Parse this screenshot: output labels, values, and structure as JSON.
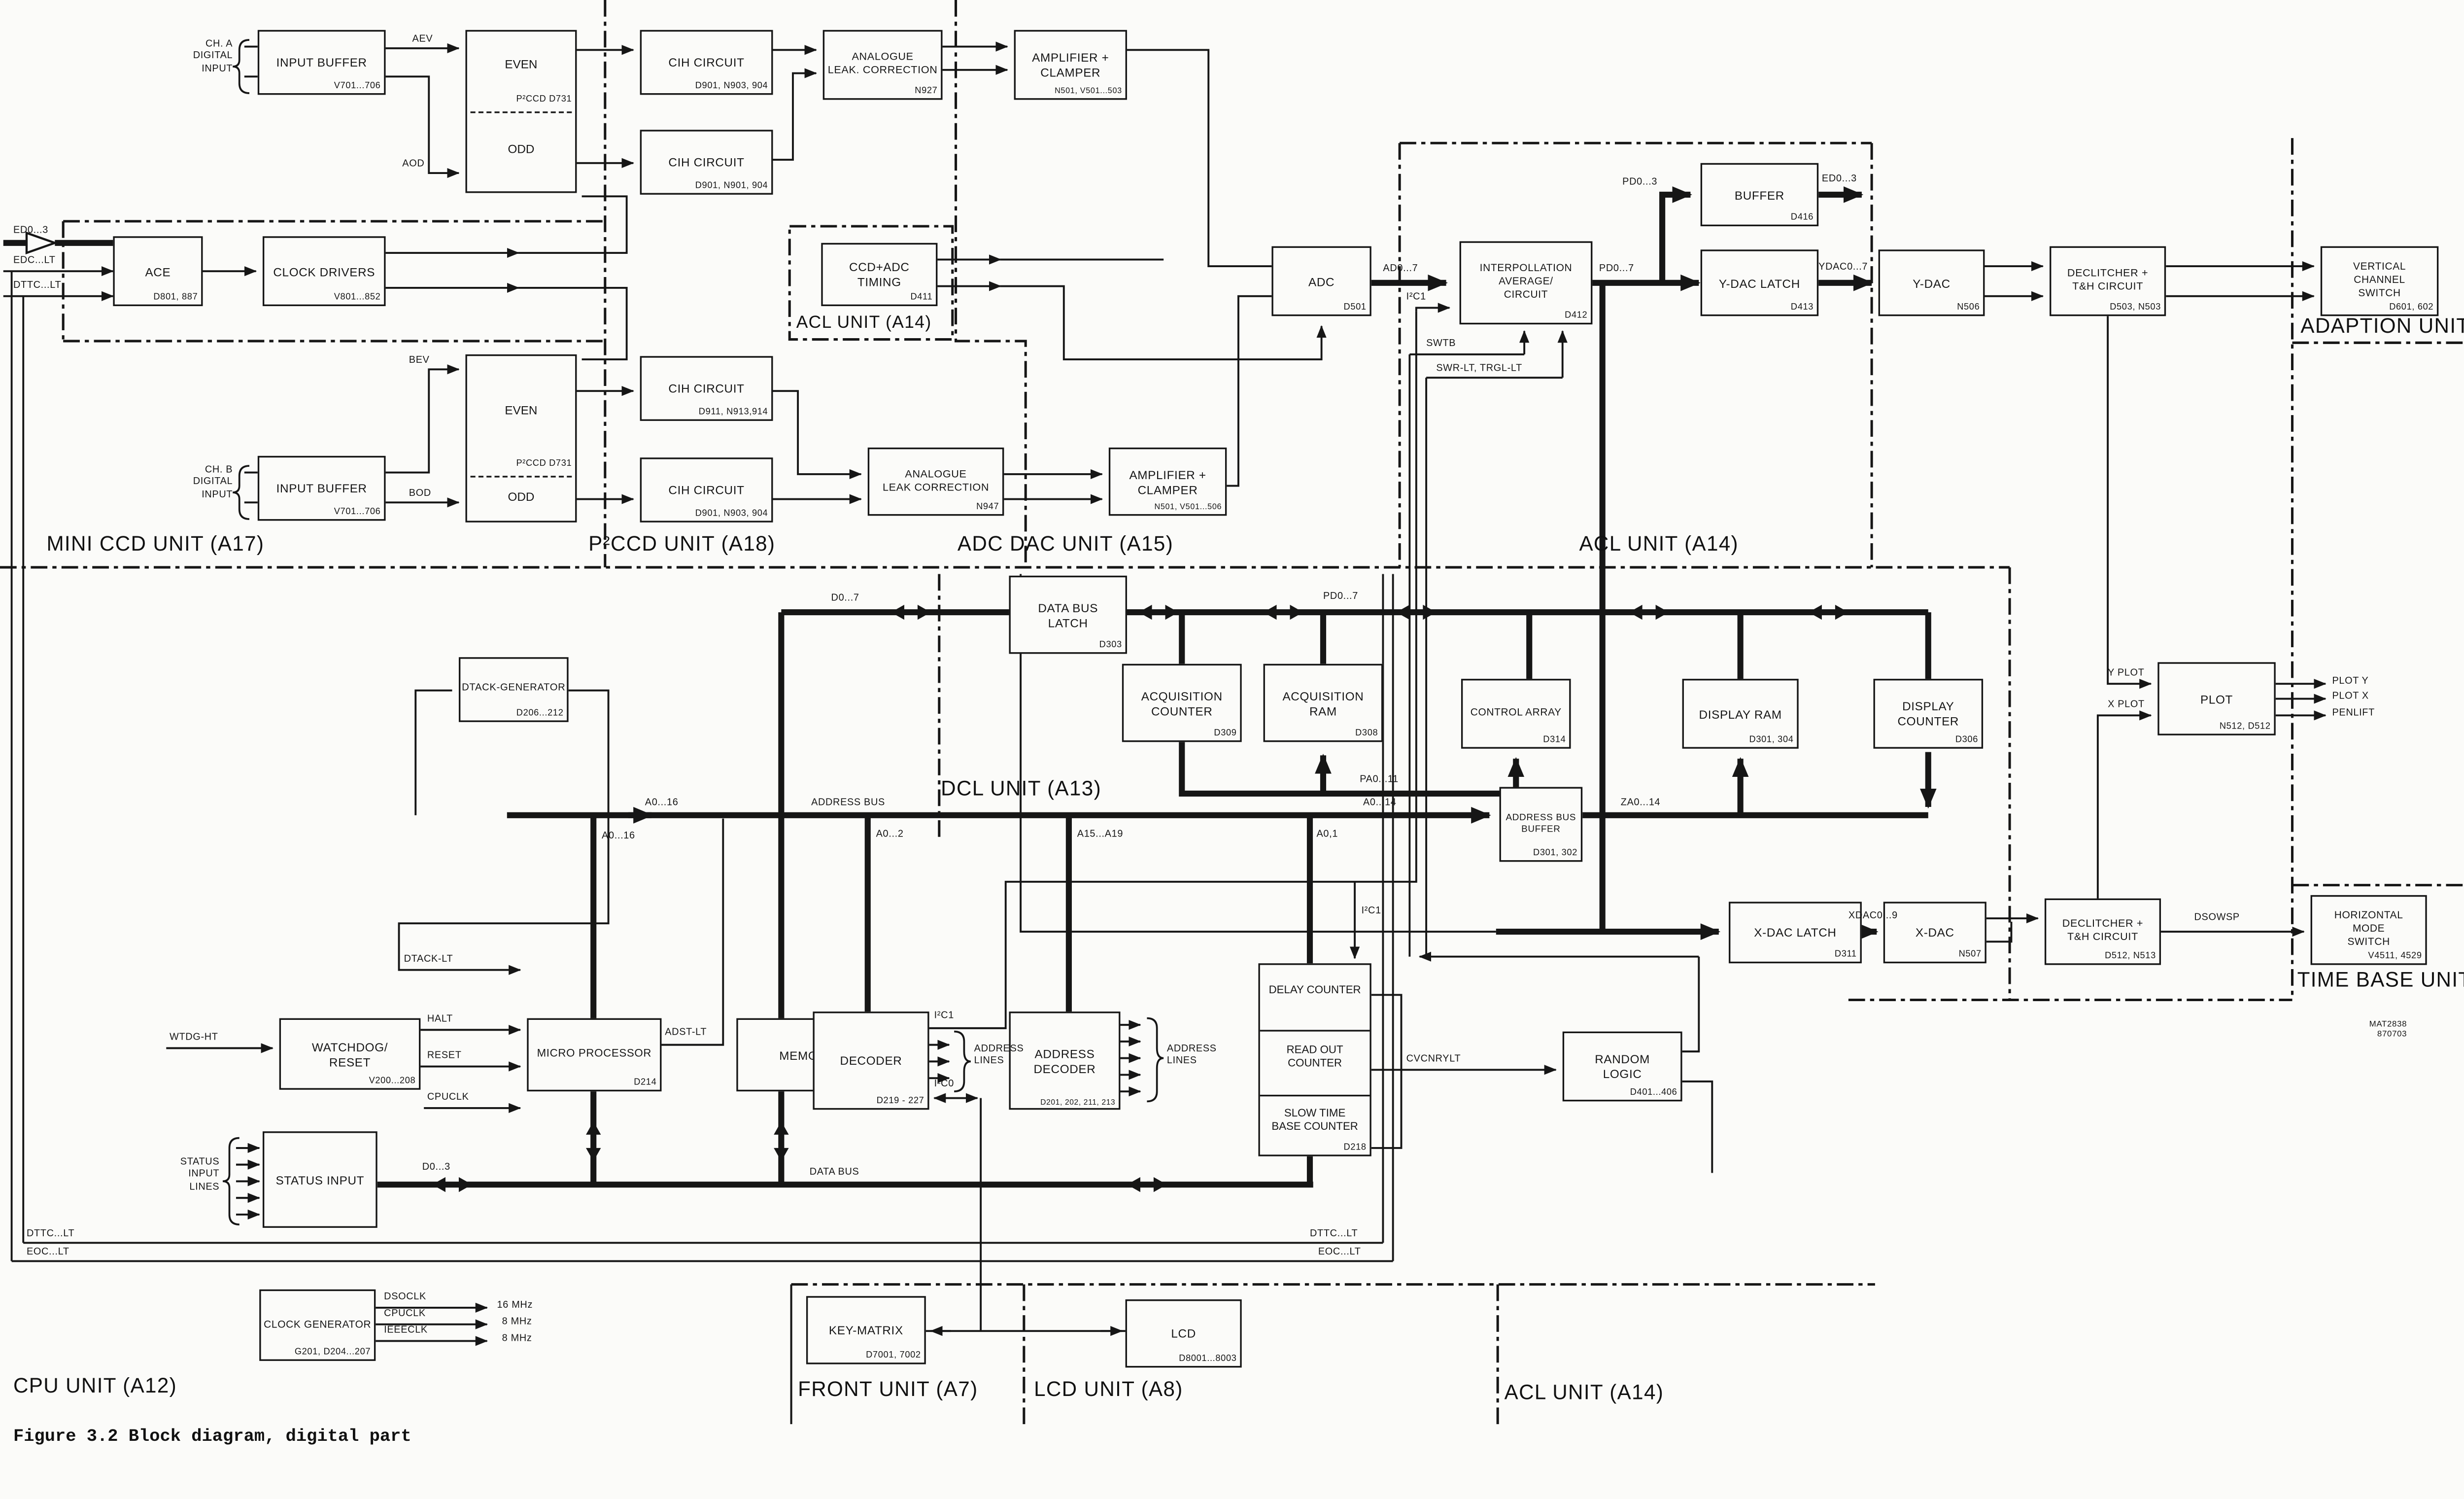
{
  "caption": "Figure 3.2 Block diagram, digital part",
  "blocks": {
    "input_buffer_a": {
      "label": "INPUT BUFFER",
      "part": "V701...706"
    },
    "even_odd_a": {
      "even": "EVEN",
      "odd": "ODD",
      "part": "P²CCD  D731"
    },
    "cih_a1": {
      "label": "CIH CIRCUIT",
      "part": "D901, N903, 904"
    },
    "cih_a2": {
      "label": "CIH CIRCUIT",
      "part": "D901, N901, 904"
    },
    "alc_a": {
      "label": "ANALOGUE\nLEAK. CORRECTION",
      "part": "N927"
    },
    "amp_a": {
      "label": "AMPLIFIER +\nCLAMPER",
      "part": "N501, V501...503"
    },
    "ace": {
      "label": "ACE",
      "part": "D801, 887"
    },
    "clock_drivers": {
      "label": "CLOCK DRIVERS",
      "part": "V801...852"
    },
    "ccd_adc_timing": {
      "label": "CCD+ADC\nTIMING",
      "part": "D411"
    },
    "input_buffer_b": {
      "label": "INPUT BUFFER",
      "part": "V701...706"
    },
    "even_odd_b": {
      "even": "EVEN",
      "odd": "ODD",
      "part": "P²CCD  D731"
    },
    "cih_b1": {
      "label": "CIH CIRCUIT",
      "part": "D911, N913,914"
    },
    "cih_b2": {
      "label": "CIH CIRCUIT",
      "part": "D901, N903, 904"
    },
    "alc_b": {
      "label": "ANALOGUE\nLEAK CORRECTION",
      "part": "N947"
    },
    "amp_b": {
      "label": "AMPLIFIER +\nCLAMPER",
      "part": "N501, V501...506"
    },
    "adc": {
      "label": "ADC",
      "part": "D501"
    },
    "interp": {
      "label": "INTERPOLLATION\nAVERAGE/\nCIRCUIT",
      "part": "D412"
    },
    "buffer": {
      "label": "BUFFER",
      "part": "D416"
    },
    "ydac_latch": {
      "label": "Y-DAC LATCH",
      "part": "D413"
    },
    "ydac": {
      "label": "Y-DAC",
      "part": "N506"
    },
    "declitcher_y": {
      "label": "DECLITCHER +\nT&H CIRCUIT",
      "part": "D503, N503"
    },
    "vcs": {
      "label": "VERTICAL\nCHANNEL\nSWITCH",
      "part": "D601, 602"
    },
    "data_bus_latch": {
      "label": "DATA BUS\nLATCH",
      "part": "D303"
    },
    "acq_counter": {
      "label": "ACQUISITION\nCOUNTER",
      "part": "D309"
    },
    "acq_ram": {
      "label": "ACQUISITION\nRAM",
      "part": "D308"
    },
    "control_array": {
      "label": "CONTROL ARRAY",
      "part": "D314"
    },
    "display_ram": {
      "label": "DISPLAY RAM",
      "part": "D301, 304"
    },
    "display_counter": {
      "label": "DISPLAY\nCOUNTER",
      "part": "D306"
    },
    "address_bus_buffer": {
      "label": "ADDRESS BUS\nBUFFER",
      "part": "D301, 302"
    },
    "plot": {
      "label": "PLOT",
      "part": "N512, D512"
    },
    "dtack_gen": {
      "label": "DTACK-GENERATOR",
      "part": "D206...212"
    },
    "watchdog": {
      "label": "WATCHDOG/\nRESET",
      "part": "V200...208"
    },
    "microprocessor": {
      "label": "MICRO PROCESSOR",
      "part": "D214"
    },
    "memory": {
      "label": "MEMORY",
      "part": "D216, 217"
    },
    "decoder": {
      "label": "DECODER",
      "part": "D219 - 227"
    },
    "addr_decoder": {
      "label": "ADDRESS\nDECODER",
      "part": "D201, 202, 211, 213"
    },
    "counters": {
      "delay": "DELAY COUNTER",
      "readout": "READ OUT\nCOUNTER",
      "slowtb": "SLOW TIME\nBASE COUNTER",
      "part": "D218"
    },
    "random_logic": {
      "label": "RANDOM\nLOGIC",
      "part": "D401...406"
    },
    "xdac_latch": {
      "label": "X-DAC LATCH",
      "part": "D311"
    },
    "xdac": {
      "label": "X-DAC",
      "part": "N507"
    },
    "declitcher_x": {
      "label": "DECLITCHER +\nT&H CIRCUIT",
      "part": "D512, N513"
    },
    "hms": {
      "label": "HORIZONTAL\nMODE\nSWITCH",
      "part": "V4511, 4529"
    },
    "status_input": {
      "label": "STATUS INPUT"
    },
    "clock_gen": {
      "label": "CLOCK GENERATOR",
      "part": "G201, D204...207"
    },
    "key_matrix": {
      "label": "KEY-MATRIX",
      "part": "D7001, 7002"
    },
    "lcd": {
      "label": "LCD",
      "part": "D8001...8003"
    }
  },
  "units": {
    "mini_ccd": "MINI CCD UNIT (A17)",
    "p2ccd": "P²CCD UNIT (A18)",
    "adc_dac": "ADC DAC UNIT (A15)",
    "acl_top": "ACL UNIT (A14)",
    "acl_mid": "ACL UNIT (A14)",
    "acl_bottom": "ACL UNIT (A14)",
    "adaption": "ADAPTION UNIT (A16)",
    "dcl": "DCL UNIT (A13)",
    "time_base": "TIME BASE UNIT (A4)",
    "cpu": "CPU UNIT (A12)",
    "front": "FRONT UNIT (A7)",
    "lcd_unit": "LCD UNIT (A8)"
  },
  "labels": {
    "ch_a": "CH. A\nDIGITAL\nINPUT",
    "ch_b": "CH. B\nDIGITAL\nINPUT",
    "aev": "AEV",
    "aod": "AOD",
    "bev": "BEV",
    "bod": "BOD",
    "ed0_3_left": "ED0...3",
    "edc_lt": "EDC...LT",
    "dttc_lt_top": "DTTC...LT",
    "ad0_7": "AD0...7",
    "i2c1_adc": "I²C1",
    "pd0_3": "PD0...3",
    "pd0_7_top": "PD0...7",
    "ed0_3_right": "ED0...3",
    "ydac0_7": "YDAC0...7",
    "swtb": "SWTB",
    "swr": "SWR-LT, TRGL-LT",
    "d0_7": "D0...7",
    "pd0_7_bus": "PD0...7",
    "pa0_11": "PA0...11",
    "a0_16_bus": "A0...16",
    "address_bus": "ADDRESS BUS",
    "a0_16_riser": "A0...16",
    "a0_2": "A0...2",
    "a15_a19": "A15...A19",
    "a0_1": "A0,1",
    "a0_14": "A0...14",
    "za0_14": "ZA0...14",
    "i2c1_delay": "I²C1",
    "xdac0_9": "XDAC0...9",
    "dsowsp": "DSOWSP",
    "y_plot": "Y PLOT",
    "x_plot": "X PLOT",
    "plot_y": "PLOT Y",
    "plot_x": "PLOT X",
    "penlift": "PENLIFT",
    "wtdg": "WTDG-HT",
    "dtack_lt": "DTACK-LT",
    "halt": "HALT",
    "reset": "RESET",
    "cpuclk_in": "CPUCLK",
    "adst": "ADST-LT",
    "i2c1_dec": "I²C1",
    "i2c0": "I²C0",
    "addr_lines_1": "ADDRESS\nLINES",
    "addr_lines_2": "ADDRESS\nLINES",
    "cvcnrylt": "CVCNRYLT",
    "status_lines": "STATUS\nINPUT\nLINES",
    "d0_3": "D0...3",
    "data_bus": "DATA BUS",
    "dsoclk": "DSOCLK",
    "cpuclk_out": "CPUCLK",
    "ieeeclk": "IEEECLK",
    "f16": "16 MHz",
    "f8a": "8 MHz",
    "f8b": "8 MHz",
    "dttc_bl": "DTTC...LT",
    "eoc_bl": "EOC...LT",
    "dttc_br": "DTTC...LT",
    "eoc_br": "EOC...LT",
    "mat": "MAT2838\n870703"
  }
}
